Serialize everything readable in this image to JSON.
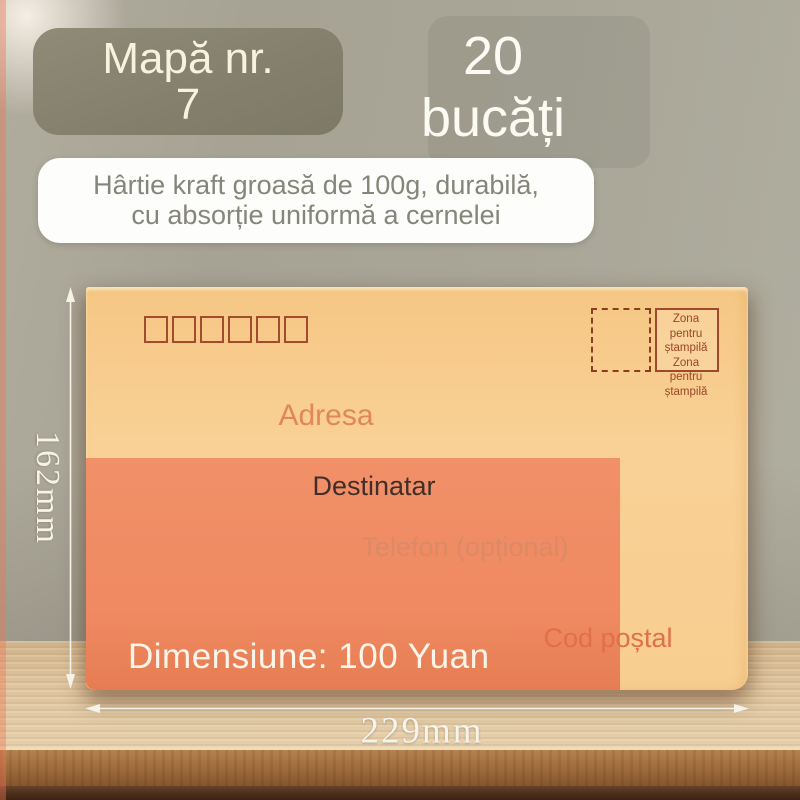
{
  "badge": {
    "line1": "Mapă nr.",
    "line2": "7"
  },
  "quantity": {
    "count": "20",
    "unit": "bucăți"
  },
  "description": {
    "line1": "Hârtie kraft groasă de 100g, durabilă,",
    "line2": "cu absorție uniformă a cernelei"
  },
  "envelope": {
    "postal_boxes_count": 6,
    "address_label": "Adresa",
    "recipient_label": "Destinatar",
    "phone_label": "Telefon (opțional)",
    "postal_code_label": "Cod poștal",
    "price_label": "Dimensiune: 100 Yuan",
    "stamp_zone": {
      "line1": "Zona",
      "line2": "pentru",
      "line3": "ștampilă"
    }
  },
  "dimensions": {
    "height_label": "162mm",
    "width_label": "229mm"
  },
  "colors": {
    "wall": "#a9a699",
    "badge_bg": "#837f6c",
    "badge_text": "#f8f1dc",
    "card_bg": "#fdfdfc",
    "card_text": "#85857a",
    "envelope_tan": "#f8cd90",
    "envelope_salmon": "#ef8961",
    "postal_box_border": "#a34b2e",
    "stamp_text": "#9c4526",
    "address_text": "#e0875c",
    "recipient_text": "#402f28",
    "phone_text": "#dc8a66",
    "postal_code_text": "#e06f4a",
    "price_text": "#fdf5e9",
    "dimension_text": "#f6f3e9",
    "wood_light": "#dcc29c",
    "wood_mid": "#9c6a3c",
    "wood_dark": "#4a2d1a"
  }
}
